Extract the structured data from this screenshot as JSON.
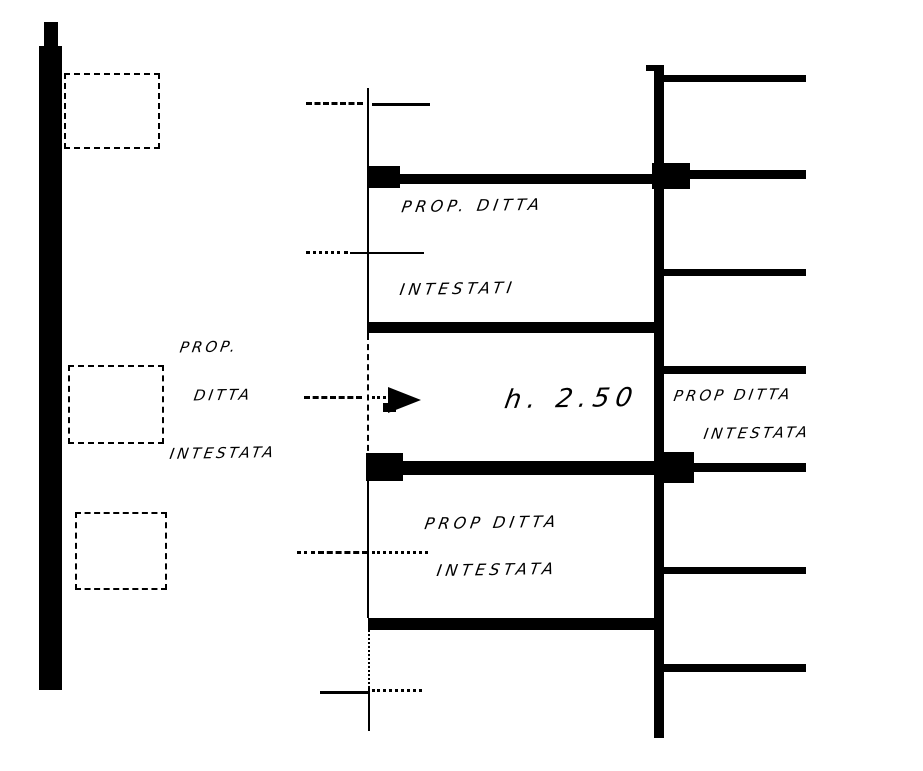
{
  "colors": {
    "ink": "#000000",
    "paper": "#ffffff"
  },
  "labels": {
    "upper_room": {
      "line1": "PROP. DITTA",
      "line2": "INTESTATI"
    },
    "middle_room": {
      "height_note": "h. 2.50"
    },
    "lower_room": {
      "line1": "PROP DITTA",
      "line2": "INTESTATA"
    },
    "left_annotation": {
      "line1": "PROP.",
      "line2": "DITTA",
      "line3": "INTESTATA"
    },
    "right_annotation": {
      "line1": "PROP DITTA",
      "line2": "INTESTATA"
    }
  },
  "icons": {
    "leader_arrow": "right-arrowhead"
  }
}
